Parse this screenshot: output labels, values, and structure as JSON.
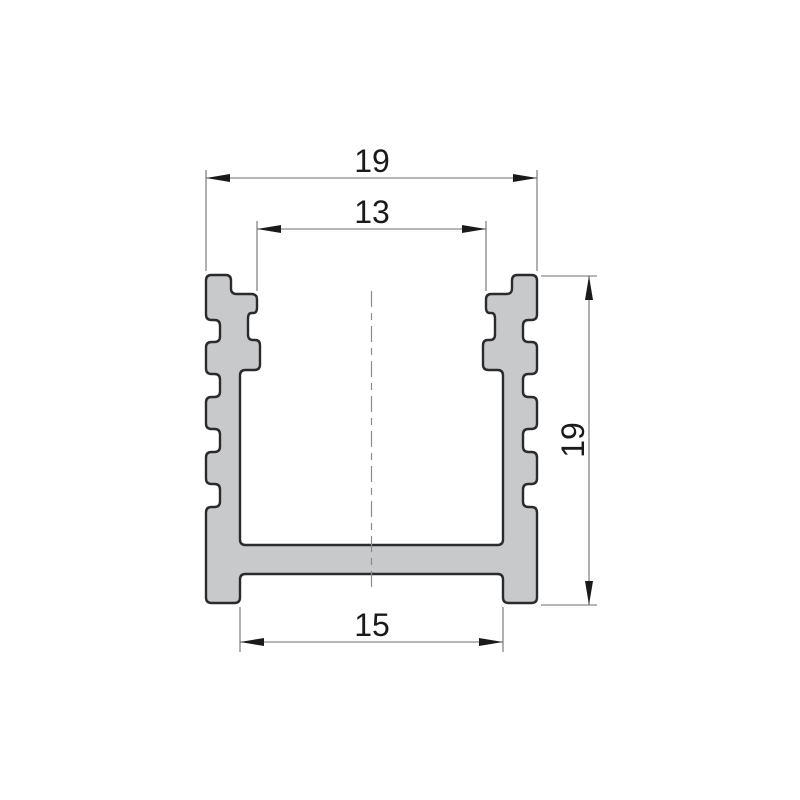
{
  "drawing": {
    "dimensions": {
      "outer_width": "19",
      "opening_width": "13",
      "inner_width": "15",
      "height": "19"
    }
  },
  "style": {
    "background": "#ffffff",
    "profile_fill": "#c8c9cb",
    "profile_stroke": "#2b2b2d",
    "dimension_line_color": "#6e6e6e",
    "arrow_color": "#1a1a1a",
    "text_color": "#1a1a1a",
    "centerline_color": "#8c8c8c"
  }
}
